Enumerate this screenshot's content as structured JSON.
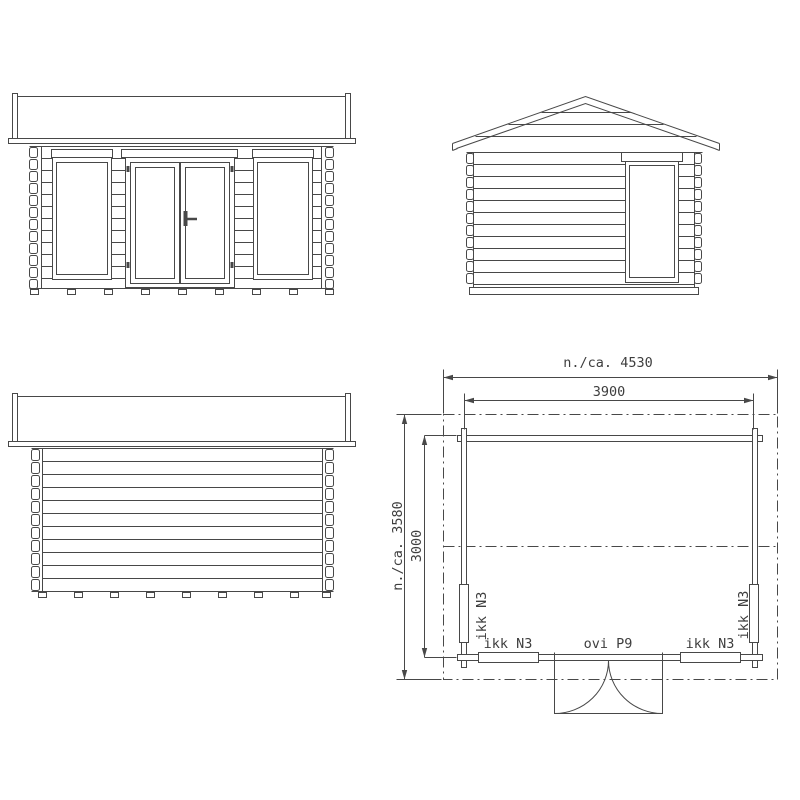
{
  "colors": {
    "line": "#484848",
    "text": "#3e3e3e",
    "background": "#ffffff"
  },
  "floor_plan": {
    "dimensions": {
      "overall_width": "n./ca. 4530",
      "wall_width": "3900",
      "overall_depth": "n./ca. 3580",
      "wall_depth": "3000"
    },
    "labels": {
      "window": "ikk N3",
      "door": "ovi P9"
    }
  }
}
